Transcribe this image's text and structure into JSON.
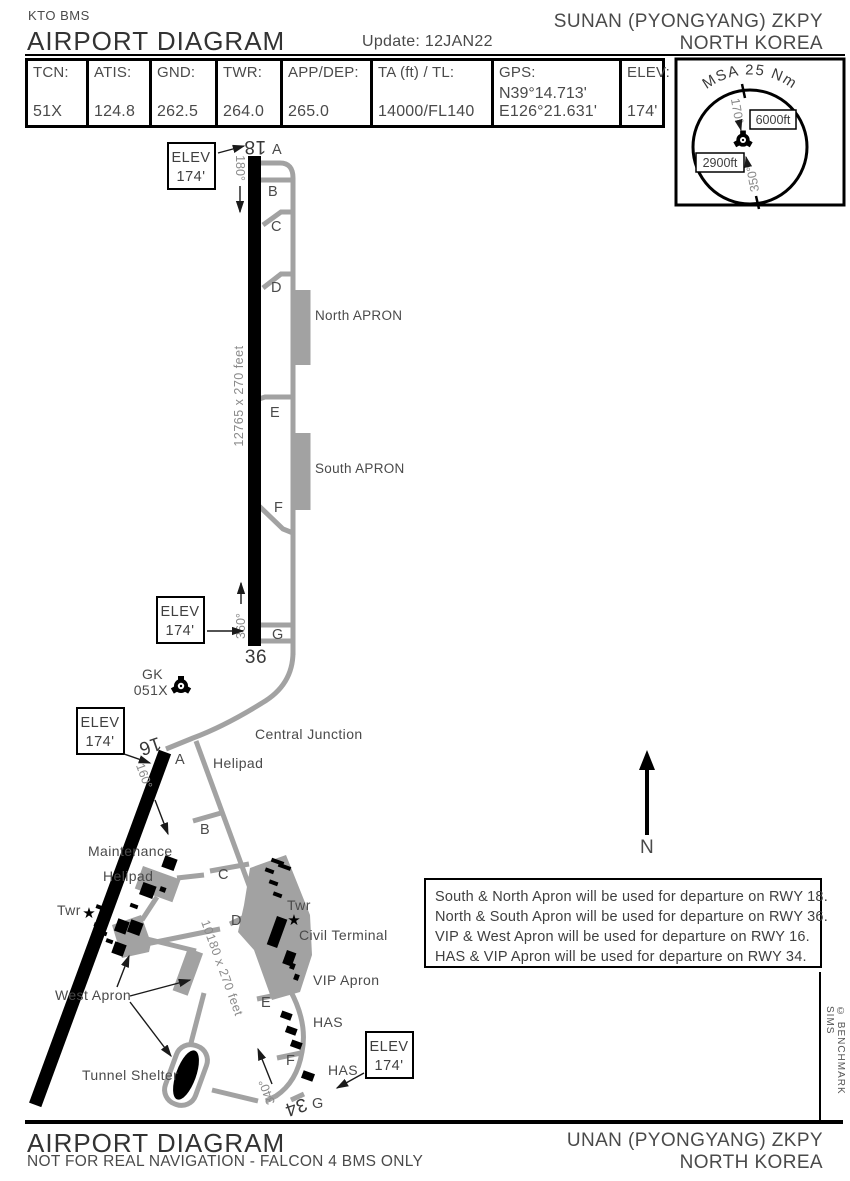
{
  "header": {
    "brand": "KTO BMS",
    "title": "AIRPORT DIAGRAM",
    "update": "Update: 12JAN22",
    "airport": "SUNAN (PYONGYANG) ZKPY",
    "country": "NORTH KOREA"
  },
  "info_table": [
    {
      "label": "TCN:",
      "value": "51X"
    },
    {
      "label": "ATIS:",
      "value": "124.8"
    },
    {
      "label": "GND:",
      "value": "262.5"
    },
    {
      "label": "TWR:",
      "value": "264.0"
    },
    {
      "label": "APP/DEP:",
      "value": "265.0"
    },
    {
      "label": "TA (ft) / TL:",
      "value": "14000/FL140"
    },
    {
      "label": "GPS:",
      "value_line1": "N39°14.713'",
      "value_line2": "E126°21.631'"
    },
    {
      "label": "ELEV:",
      "value": "174'"
    }
  ],
  "msa": {
    "title": "MSA 25 Nm",
    "alt_high": "6000ft",
    "alt_low": "2900ft",
    "bearing_north": "170°",
    "bearing_south": "350°"
  },
  "beacon": {
    "ident": "GK",
    "channel": "051X"
  },
  "rwy1836": {
    "num_n": "18",
    "num_s": "36",
    "hdg_n": "180°",
    "hdg_s": "360°",
    "dim": "12765 x 270 feet",
    "taxiways": [
      "A",
      "B",
      "C",
      "D",
      "E",
      "F",
      "G"
    ],
    "north_apron": "North APRON",
    "south_apron": "South APRON"
  },
  "rwy1634": {
    "num_n": "16",
    "num_s": "34",
    "hdg_n": "160°",
    "hdg_s": "340°",
    "dim": "10180 x 270 feet",
    "taxiways": [
      "A",
      "B",
      "C",
      "D",
      "E",
      "F",
      "G"
    ]
  },
  "labels": {
    "central_junction": "Central Junction",
    "helipad": "Helipad",
    "maintenance_line1": "Maintenance",
    "maintenance_line2": "Helipad",
    "twr": "Twr",
    "civil_terminal": "Civil Terminal",
    "vip_apron": "VIP Apron",
    "west_apron": "West Apron",
    "tunnel_shelter": "Tunnel Shelter",
    "has": "HAS",
    "north": "N"
  },
  "elev_box": {
    "line1": "ELEV",
    "line2": "174'"
  },
  "notes": [
    "South & North Apron will be used for departure  on RWY 18.",
    "North & South Apron will be used for departure on RWY 36.",
    "VIP & West Apron will be used for departure on RWY 16.",
    "HAS & VIP Apron will be used for departure on RWY 34."
  ],
  "footer": {
    "title": "AIRPORT DIAGRAM",
    "subtitle": "NOT FOR REAL NAVIGATION - FALCON 4 BMS ONLY",
    "airport": "UNAN (PYONGYANG) ZKPY",
    "country": "NORTH KOREA"
  },
  "copyright": "© BENCHMARK SIMS",
  "icons": {
    "tower_star": "★"
  },
  "colors": {
    "ink": "#000000",
    "taxiway": "#a2a2a2",
    "text_dark": "#3f3f3f",
    "text_gray": "#8a8a8a"
  }
}
